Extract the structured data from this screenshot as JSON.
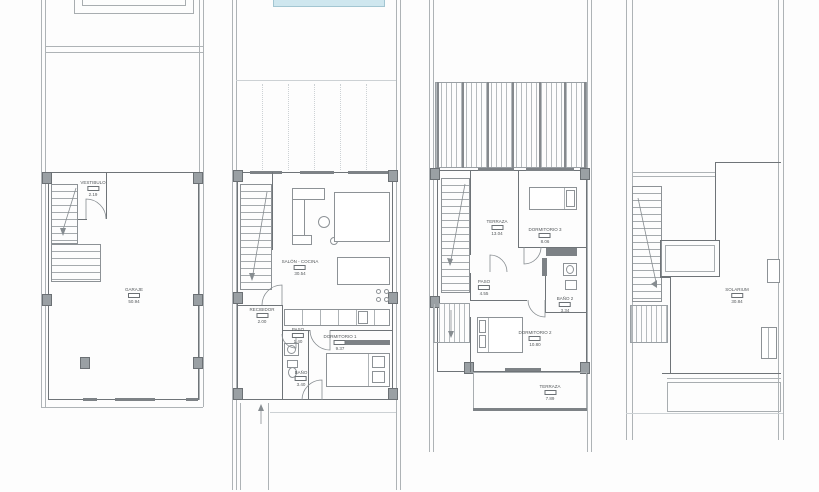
{
  "sheet": {
    "type": "architectural-floor-plans",
    "plan_count": 4
  },
  "colors": {
    "pool": "#cfe7ef",
    "line": "#aeb3b6",
    "wall": "#6f7478",
    "column": "#9aa0a4",
    "text": "#54585b"
  },
  "plans": [
    {
      "key": "basement-garage",
      "rooms": [
        {
          "name": "VESTIBULO",
          "area": "2.19"
        },
        {
          "name": "GARAJE",
          "area": "50.94"
        }
      ]
    },
    {
      "key": "ground-floor",
      "rooms": [
        {
          "name": "SALÓN - COCINA",
          "area": "30.54"
        },
        {
          "name": "RECIBIDOR",
          "area": "2.00"
        },
        {
          "name": "PASO",
          "area": "1.40"
        },
        {
          "name": "BAÑO",
          "area": "3.40"
        },
        {
          "name": "DORMITORIO 1",
          "area": "9.37"
        }
      ]
    },
    {
      "key": "first-floor",
      "rooms": [
        {
          "name": "TERRAZA",
          "area": "13.04"
        },
        {
          "name": "DORMITORIO 3",
          "area": "8.06"
        },
        {
          "name": "PASO",
          "area": "4.55"
        },
        {
          "name": "BAÑO 2",
          "area": "3.34"
        },
        {
          "name": "DORMITORIO 2",
          "area": "10.80"
        },
        {
          "name": "TERRAZA",
          "area": "7.89"
        }
      ]
    },
    {
      "key": "roof-solarium",
      "rooms": [
        {
          "name": "SOLARIUM",
          "area": "30.84"
        }
      ]
    }
  ]
}
